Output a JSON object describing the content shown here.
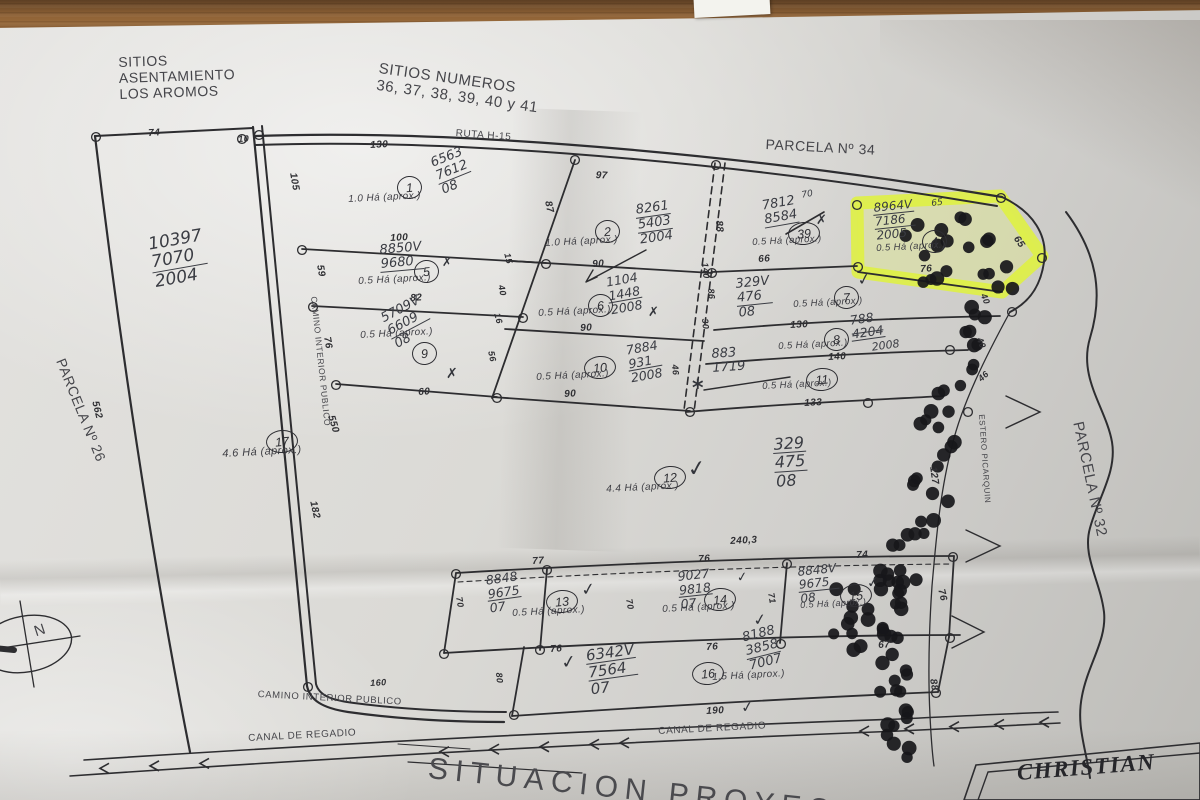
{
  "scene": {
    "desk_color": "#8f6236",
    "paper_color": "#d8d7d3",
    "highlight_color": "#e6f53e",
    "ink_color": "#303034",
    "hand_color": "#3b3d44"
  },
  "map_labels": [
    {
      "n": "sitios-header",
      "t": "SITIOS\nASENTAMIENTO\nLOS AROMOS",
      "x": 118,
      "y": 54,
      "s": 14,
      "r": -2,
      "cls": "print"
    },
    {
      "n": "sitios-numeros",
      "t": "SITIOS NUMEROS\n36, 37, 38, 39, 40 y 41",
      "x": 380,
      "y": 60,
      "s": 15,
      "r": 8,
      "cls": "print"
    },
    {
      "n": "parcela-34-label",
      "t": "PARCELA Nº 34",
      "x": 766,
      "y": 136,
      "s": 14,
      "r": 3,
      "cls": "print"
    },
    {
      "n": "ruta-h15-label",
      "t": "RUTA H-15",
      "x": 456,
      "y": 128,
      "s": 10,
      "r": 4,
      "cls": "print"
    },
    {
      "n": "parcela-26-label",
      "t": "PARCELA Nº 26",
      "x": 68,
      "y": 356,
      "s": 14,
      "r": 68,
      "cls": "print"
    },
    {
      "n": "parcela-32-label",
      "t": "PARCELA Nº 32",
      "x": 1086,
      "y": 420,
      "s": 15,
      "r": 78,
      "cls": "print"
    },
    {
      "n": "estero-picarquin-label",
      "t": "ESTERO PICARQUIN",
      "x": 986,
      "y": 414,
      "s": 8,
      "r": 86,
      "cls": "print"
    },
    {
      "n": "camino-diagonal-label",
      "t": "CAMINO INTERIOR PUBLICO",
      "x": 318,
      "y": 296,
      "s": 8.5,
      "r": 84,
      "cls": "print"
    },
    {
      "n": "camino-bottom-label",
      "t": "CAMINO INTERIOR PUBLICO",
      "x": 258,
      "y": 690,
      "s": 9.5,
      "r": 3,
      "cls": "print"
    },
    {
      "n": "canal-label-1",
      "t": "CANAL DE REGADIO",
      "x": 248,
      "y": 733,
      "s": 10,
      "r": -3,
      "cls": "print"
    },
    {
      "n": "canal-label-2",
      "t": "CANAL DE REGADIO",
      "x": 658,
      "y": 726,
      "s": 10,
      "r": -3,
      "cls": "print"
    },
    {
      "n": "situacion-title",
      "t": "SITUACION PROYECTO",
      "x": 430,
      "y": 752,
      "s": 30,
      "r": 6,
      "cls": "print-big"
    },
    {
      "n": "christian-title",
      "t": "CHRISTIAN",
      "x": 1016,
      "y": 760,
      "s": 23,
      "r": -4.5,
      "cls": "serif"
    },
    {
      "n": "north-letter",
      "t": "N",
      "x": 32,
      "y": 624,
      "s": 15,
      "r": -18,
      "cls": "print"
    }
  ],
  "dimensions": [
    {
      "v": "74",
      "x": 148,
      "y": 128
    },
    {
      "v": "10",
      "x": 238,
      "y": 134,
      "s": 9
    },
    {
      "v": "130",
      "x": 370,
      "y": 140
    },
    {
      "v": "97",
      "x": 596,
      "y": 170,
      "r": 3
    },
    {
      "v": "105",
      "x": 298,
      "y": 172,
      "r": 80
    },
    {
      "v": "87",
      "x": 553,
      "y": 200,
      "r": 78
    },
    {
      "v": "100",
      "x": 390,
      "y": 233
    },
    {
      "v": "59",
      "x": 325,
      "y": 264,
      "r": 80
    },
    {
      "v": "15",
      "x": 512,
      "y": 252,
      "r": 76,
      "s": 9
    },
    {
      "v": "90",
      "x": 592,
      "y": 259
    },
    {
      "v": "66",
      "x": 758,
      "y": 254
    },
    {
      "v": "88",
      "x": 724,
      "y": 220,
      "r": 85
    },
    {
      "v": "76",
      "x": 920,
      "y": 264
    },
    {
      "v": "65",
      "x": 1020,
      "y": 234,
      "r": 55
    },
    {
      "v": "82",
      "x": 410,
      "y": 293
    },
    {
      "v": "40",
      "x": 506,
      "y": 284,
      "r": 77,
      "s": 9
    },
    {
      "v": "140",
      "x": 710,
      "y": 262,
      "r": 85,
      "s": 9
    },
    {
      "v": "86",
      "x": 716,
      "y": 288,
      "r": 85,
      "s": 9
    },
    {
      "v": "90",
      "x": 580,
      "y": 323
    },
    {
      "v": "76",
      "x": 332,
      "y": 336,
      "r": 80
    },
    {
      "v": "130",
      "x": 790,
      "y": 320
    },
    {
      "v": "40",
      "x": 988,
      "y": 292,
      "r": 68,
      "s": 9
    },
    {
      "v": "30",
      "x": 710,
      "y": 318,
      "r": 85,
      "s": 9
    },
    {
      "v": "16",
      "x": 502,
      "y": 312,
      "r": 76,
      "s": 9
    },
    {
      "v": "56",
      "x": 496,
      "y": 350,
      "r": 78,
      "s": 9
    },
    {
      "v": "140",
      "x": 828,
      "y": 352
    },
    {
      "v": "40",
      "x": 984,
      "y": 336,
      "r": 68,
      "s": 9
    },
    {
      "v": "90",
      "x": 564,
      "y": 389
    },
    {
      "v": "60",
      "x": 418,
      "y": 387
    },
    {
      "v": "46",
      "x": 680,
      "y": 364,
      "r": 85,
      "s": 9
    },
    {
      "v": "133",
      "x": 804,
      "y": 398
    },
    {
      "v": "46",
      "x": 976,
      "y": 376,
      "r": -42,
      "s": 9
    },
    {
      "v": "562",
      "x": 100,
      "y": 400,
      "r": 76
    },
    {
      "v": "550",
      "x": 336,
      "y": 414,
      "r": 74
    },
    {
      "v": "182",
      "x": 318,
      "y": 500,
      "r": 77
    },
    {
      "v": "127",
      "x": 938,
      "y": 466,
      "r": 82
    },
    {
      "v": "240,3",
      "x": 730,
      "y": 536
    },
    {
      "v": "77",
      "x": 532,
      "y": 556
    },
    {
      "v": "76",
      "x": 698,
      "y": 554
    },
    {
      "v": "74",
      "x": 856,
      "y": 550
    },
    {
      "v": "70",
      "x": 464,
      "y": 596,
      "r": 80,
      "s": 9
    },
    {
      "v": "70",
      "x": 634,
      "y": 598,
      "r": 80,
      "s": 9
    },
    {
      "v": "71",
      "x": 776,
      "y": 592,
      "r": 80,
      "s": 9
    },
    {
      "v": "76",
      "x": 946,
      "y": 588,
      "r": 76
    },
    {
      "v": "76",
      "x": 550,
      "y": 644
    },
    {
      "v": "76",
      "x": 706,
      "y": 642
    },
    {
      "v": "67",
      "x": 878,
      "y": 640
    },
    {
      "v": "160",
      "x": 370,
      "y": 678,
      "s": 9
    },
    {
      "v": "80",
      "x": 504,
      "y": 672,
      "r": 85,
      "s": 9
    },
    {
      "v": "190",
      "x": 706,
      "y": 706
    },
    {
      "v": "88",
      "x": 938,
      "y": 678,
      "r": 80
    }
  ],
  "parcels": [
    {
      "label": "1",
      "area": "1.0 Há (aprox.)",
      "nx": 397,
      "ny": 176,
      "ax": 348,
      "ay": 194
    },
    {
      "label": "2",
      "area": "1.0 Há (aprox.)",
      "nx": 595,
      "ny": 220,
      "ax": 545,
      "ay": 238
    },
    {
      "label": "39",
      "area": "0.5 Há (aprox.)",
      "nx": 788,
      "ny": 222,
      "ax": 752,
      "ay": 238,
      "as": 9.5
    },
    {
      "label": "4",
      "area": "0.5 Há (aprox.)",
      "nx": 922,
      "ny": 230,
      "ax": 876,
      "ay": 244,
      "as": 9.5
    },
    {
      "label": "5",
      "area": "0.5 Há (aprox.)",
      "nx": 414,
      "ny": 260,
      "ax": 358,
      "ay": 276
    },
    {
      "label": "6",
      "area": "0.5 Há (aprox.)",
      "nx": 588,
      "ny": 294,
      "ax": 538,
      "ay": 308
    },
    {
      "label": "7",
      "area": "0.5 Há (aprox.)",
      "nx": 834,
      "ny": 286,
      "ax": 793,
      "ay": 300,
      "as": 9.5
    },
    {
      "label": "8",
      "area": "0.5 Há (aprox.)",
      "nx": 824,
      "ny": 328,
      "ax": 778,
      "ay": 342,
      "as": 9.5
    },
    {
      "label": "9",
      "area": "0.5 Há (aprox.)",
      "nx": 412,
      "ny": 342,
      "ax": 360,
      "ay": 330
    },
    {
      "label": "10",
      "area": "0.5 Há (aprox.)",
      "nx": 584,
      "ny": 356,
      "ax": 536,
      "ay": 372
    },
    {
      "label": "11",
      "area": "0.5 Há (aprox.)",
      "nx": 806,
      "ny": 368,
      "ax": 762,
      "ay": 382,
      "as": 9.5
    },
    {
      "label": "12",
      "area": "4.4 Há (aprox.)",
      "nx": 654,
      "ny": 466,
      "ax": 606,
      "ay": 484
    },
    {
      "label": "13",
      "area": "0.5 Há (aprox.)",
      "nx": 546,
      "ny": 590,
      "ax": 512,
      "ay": 608
    },
    {
      "label": "14",
      "area": "0.5 Há (aprox.)",
      "nx": 704,
      "ny": 588,
      "ax": 662,
      "ay": 604
    },
    {
      "label": "15",
      "area": "0.5 Há (aprox.)",
      "nx": 840,
      "ny": 584,
      "ax": 800,
      "ay": 600,
      "as": 9
    },
    {
      "label": "16",
      "area": "1.5 Há (aprox.)",
      "nx": 692,
      "ny": 662,
      "ax": 712,
      "ay": 672
    },
    {
      "label": "17",
      "area": "4.6 Há (aprox.)",
      "nx": 266,
      "ny": 430,
      "ax": 222,
      "ay": 448,
      "as": 11
    }
  ],
  "hand_notes": [
    {
      "lines": [
        "6563",
        "7612",
        "08"
      ],
      "x": 428,
      "y": 158,
      "r": -22,
      "s": 13,
      "ul": [
        1
      ]
    },
    {
      "lines": [
        "8261",
        "5403",
        "2004"
      ],
      "x": 634,
      "y": 204,
      "r": -8,
      "s": 13,
      "ul": [
        0,
        1
      ]
    },
    {
      "lines": [
        "7812",
        "8584"
      ],
      "x": 760,
      "y": 200,
      "r": -10,
      "s": 13,
      "ul": [
        1
      ]
    },
    {
      "lines": [
        "70"
      ],
      "x": 800,
      "y": 192,
      "r": -10,
      "s": 9
    },
    {
      "lines": [
        "8964V",
        "7186",
        "2005"
      ],
      "x": 872,
      "y": 202,
      "r": -6,
      "s": 12,
      "ul": [
        0,
        1
      ]
    },
    {
      "lines": [
        "65"
      ],
      "x": 930,
      "y": 200,
      "r": -6,
      "s": 9
    },
    {
      "lines": [
        "8850V",
        "9680"
      ],
      "x": 378,
      "y": 244,
      "r": -5,
      "s": 13,
      "ul": [
        1
      ]
    },
    {
      "lines": [
        "1104",
        "1448",
        "2008"
      ],
      "x": 604,
      "y": 276,
      "r": -10,
      "s": 12.5,
      "ul": [
        1
      ]
    },
    {
      "lines": [
        "329V",
        "476",
        "08"
      ],
      "x": 734,
      "y": 278,
      "r": -6,
      "s": 13,
      "ul": [
        1
      ]
    },
    {
      "lines": [
        "788",
        "4204"
      ],
      "x": 848,
      "y": 314,
      "r": -8,
      "s": 12.5,
      "ul": [
        1
      ],
      "st": [
        1
      ]
    },
    {
      "lines": [
        "2008"
      ],
      "x": 870,
      "y": 342,
      "r": -8,
      "s": 11
    },
    {
      "lines": [
        "5709V",
        "6609",
        "08"
      ],
      "x": 378,
      "y": 314,
      "r": -28,
      "s": 13,
      "ul": [
        1
      ]
    },
    {
      "lines": [
        "7884",
        "931",
        "2008"
      ],
      "x": 624,
      "y": 344,
      "r": -10,
      "s": 12.5,
      "ul": [
        1
      ]
    },
    {
      "lines": [
        "883",
        "1719"
      ],
      "x": 710,
      "y": 348,
      "r": -4,
      "s": 13
    },
    {
      "lines": [
        "10397",
        "7070",
        "2004"
      ],
      "x": 146,
      "y": 236,
      "r": -10,
      "s": 17,
      "ul": [
        1
      ]
    },
    {
      "lines": [
        "329",
        "475",
        "08"
      ],
      "x": 772,
      "y": 436,
      "r": -4,
      "s": 16,
      "ul": [
        0,
        1
      ]
    },
    {
      "lines": [
        "8848",
        "9675",
        "07"
      ],
      "x": 484,
      "y": 574,
      "r": -8,
      "s": 12.5,
      "ul": [
        1
      ]
    },
    {
      "lines": [
        "9027",
        "9818",
        "07"
      ],
      "x": 676,
      "y": 570,
      "r": -6,
      "s": 12.5,
      "ul": [
        1
      ]
    },
    {
      "lines": [
        "8848V",
        "9675",
        "08"
      ],
      "x": 796,
      "y": 566,
      "r": -6,
      "s": 12,
      "ul": [
        1
      ]
    },
    {
      "lines": [
        "6342V",
        "7564",
        "07"
      ],
      "x": 584,
      "y": 648,
      "r": -8,
      "s": 15,
      "ul": [
        0,
        1
      ]
    },
    {
      "lines": [
        "8188",
        "3858",
        "7007"
      ],
      "x": 740,
      "y": 632,
      "r": -14,
      "s": 13,
      "ul": [
        1
      ]
    }
  ],
  "marks": [
    {
      "t": "✓",
      "x": 856,
      "y": 272,
      "s": 16,
      "r": -10
    },
    {
      "t": "✗",
      "x": 816,
      "y": 214,
      "s": 13
    },
    {
      "t": "✗",
      "x": 442,
      "y": 256,
      "s": 12
    },
    {
      "t": "✗",
      "x": 648,
      "y": 306,
      "s": 13
    },
    {
      "t": "✗",
      "x": 446,
      "y": 366,
      "s": 14
    },
    {
      "t": "*",
      "x": 692,
      "y": 376,
      "s": 22
    },
    {
      "t": "✓",
      "x": 686,
      "y": 458,
      "s": 22,
      "r": -8
    },
    {
      "t": "✓",
      "x": 580,
      "y": 582,
      "s": 17,
      "r": -8
    },
    {
      "t": "✓",
      "x": 736,
      "y": 572,
      "s": 13,
      "r": -8
    },
    {
      "t": "✓",
      "x": 752,
      "y": 612,
      "s": 16,
      "r": -8
    },
    {
      "t": "✓",
      "x": 866,
      "y": 576,
      "s": 14,
      "r": -8
    },
    {
      "t": "✓",
      "x": 560,
      "y": 654,
      "s": 18,
      "r": -8
    },
    {
      "t": "✓",
      "x": 740,
      "y": 700,
      "s": 15,
      "r": -8
    }
  ]
}
